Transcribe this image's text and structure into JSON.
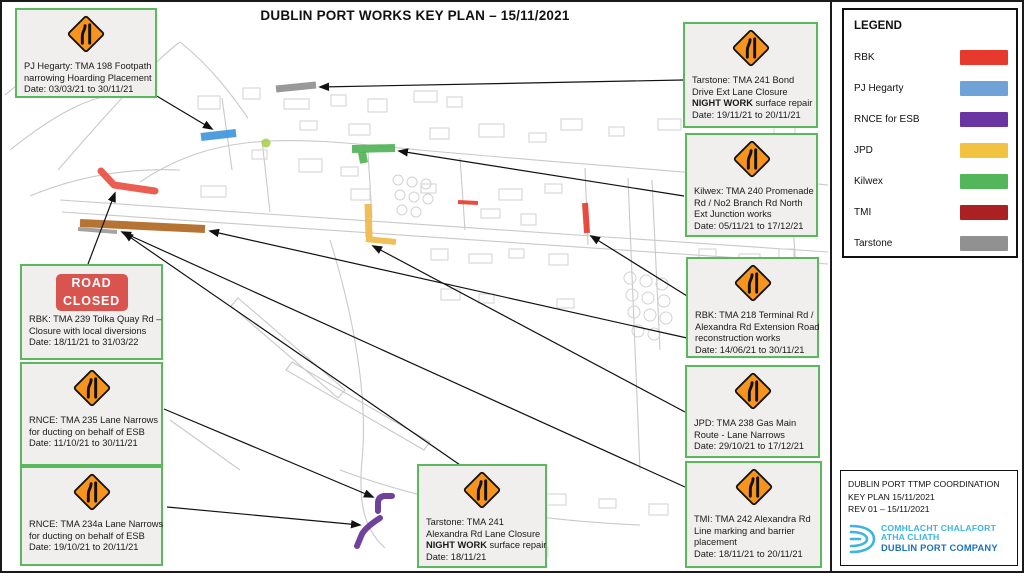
{
  "title": "DUBLIN PORT WORKS KEY PLAN – 15/11/2021",
  "colors": {
    "callout_border": "#5cb85c",
    "sign_orange": "#f7941e",
    "road_closed_red": "#d9534f",
    "logo_light_blue": "#3cb4e5",
    "logo_dark_blue": "#1d71b8",
    "arrow_black": "#111111"
  },
  "legend": {
    "title": "LEGEND",
    "items": [
      {
        "label": "RBK",
        "color": "#e63a2e"
      },
      {
        "label": "PJ Hegarty",
        "color": "#6fa3d8"
      },
      {
        "label": "RNCE for ESB",
        "color": "#6a35a3"
      },
      {
        "label": "JPD",
        "color": "#f2c340"
      },
      {
        "label": "Kilwex",
        "color": "#53b65a"
      },
      {
        "label": "TMI",
        "color": "#aa2023"
      },
      {
        "label": "Tarstone",
        "color": "#919191"
      }
    ]
  },
  "info_box": {
    "lines": [
      "DUBLIN PORT TTMP COORDINATION",
      "KEY PLAN  15/11/2021",
      "REV 01 – 15/11/2021"
    ],
    "logo": {
      "line1": "COMHLACHT CHALAFORT",
      "line2": "ATHA CLIATH",
      "line3": "DUBLIN PORT COMPANY"
    }
  },
  "callouts": [
    {
      "id": "pj-hegarty-198",
      "sign": "narrows",
      "box": {
        "x": 15,
        "y": 8,
        "w": 142,
        "h": 90
      },
      "lines": [
        [
          {
            "t": "PJ Hegarty: TMA 198 Footpath"
          }
        ],
        [
          {
            "t": "narrowing Hoarding Placement"
          }
        ],
        [
          {
            "t": "Date: 03/03/21 to 30/11/21"
          }
        ]
      ]
    },
    {
      "id": "rbk-239",
      "sign": "road_closed",
      "sign_text": [
        "ROAD",
        "CLOSED"
      ],
      "box": {
        "x": 20,
        "y": 264,
        "w": 143,
        "h": 96
      },
      "lines": [
        [
          {
            "t": "RBK: TMA 239 Tolka Quay Rd –"
          }
        ],
        [
          {
            "t": "Closure with local diversions"
          }
        ],
        [
          {
            "t": "Date: 18/11/21 to 31/03/22"
          }
        ]
      ]
    },
    {
      "id": "rnce-235",
      "sign": "narrows",
      "box": {
        "x": 20,
        "y": 362,
        "w": 143,
        "h": 104
      },
      "lines": [
        [
          {
            "t": "RNCE: TMA 235 Lane Narrows"
          }
        ],
        [
          {
            "t": "for ducting on behalf of ESB"
          }
        ],
        [
          {
            "t": "Date: 11/10/21 to 30/11/21"
          }
        ]
      ]
    },
    {
      "id": "rnce-234a",
      "sign": "narrows",
      "box": {
        "x": 20,
        "y": 466,
        "w": 143,
        "h": 100
      },
      "lines": [
        [
          {
            "t": "RNCE: TMA 234a Lane Narrows"
          }
        ],
        [
          {
            "t": "for ducting on behalf of ESB"
          }
        ],
        [
          {
            "t": "Date: 19/10/21 to 20/11/21"
          }
        ]
      ]
    },
    {
      "id": "tarstone-241-alexandra",
      "sign": "narrows",
      "box": {
        "x": 417,
        "y": 464,
        "w": 130,
        "h": 104
      },
      "lines": [
        [
          {
            "t": "Tarstone: TMA 241"
          }
        ],
        [
          {
            "t": "Alexandra Rd Lane Closure"
          }
        ],
        [
          {
            "t": "NIGHT WORK",
            "b": true
          },
          {
            "t": " surface repair"
          }
        ],
        [
          {
            "t": "Date: 18/11/21"
          }
        ]
      ]
    },
    {
      "id": "tarstone-241-bond",
      "sign": "narrows",
      "box": {
        "x": 683,
        "y": 22,
        "w": 135,
        "h": 106
      },
      "lines": [
        [
          {
            "t": "Tarstone: TMA 241 Bond"
          }
        ],
        [
          {
            "t": "Drive Ext Lane Closure"
          }
        ],
        [
          {
            "t": "NIGHT WORK",
            "b": true
          },
          {
            "t": " surface repair"
          }
        ],
        [
          {
            "t": "Date: 19/11/21 to 20/11/21"
          }
        ]
      ]
    },
    {
      "id": "kilwex-240",
      "sign": "narrows",
      "box": {
        "x": 685,
        "y": 133,
        "w": 133,
        "h": 104
      },
      "lines": [
        [
          {
            "t": "Kilwex: TMA 240 Promenade"
          }
        ],
        [
          {
            "t": "Rd / No2 Branch Rd North"
          }
        ],
        [
          {
            "t": "Ext Junction works"
          }
        ],
        [
          {
            "t": "Date: 05/11/21 to 17/12/21"
          }
        ]
      ]
    },
    {
      "id": "rbk-218",
      "sign": "narrows",
      "box": {
        "x": 686,
        "y": 257,
        "w": 133,
        "h": 101
      },
      "lines": [
        [
          {
            "t": "RBK: TMA 218 Terminal Rd /"
          }
        ],
        [
          {
            "t": "Alexandra Rd Extension Road"
          }
        ],
        [
          {
            "t": "reconstruction works"
          }
        ],
        [
          {
            "t": "Date: 14/06/21 to 30/11/21"
          }
        ]
      ]
    },
    {
      "id": "jpd-238",
      "sign": "narrows",
      "box": {
        "x": 685,
        "y": 365,
        "w": 135,
        "h": 93
      },
      "lines": [
        [
          {
            "t": "JPD: TMA 238 Gas Main"
          }
        ],
        [
          {
            "t": "Route - Lane Narrows"
          }
        ],
        [
          {
            "t": "Date: 29/10/21 to 17/12/21"
          }
        ]
      ]
    },
    {
      "id": "tmi-242",
      "sign": "narrows",
      "box": {
        "x": 685,
        "y": 461,
        "w": 137,
        "h": 107
      },
      "lines": [
        [
          {
            "t": "TMI: TMA 242 Alexandra Rd"
          }
        ],
        [
          {
            "t": "Line marking and barrier"
          }
        ],
        [
          {
            "t": "placement"
          }
        ],
        [
          {
            "t": "Date: 18/11/21 to 20/11/21"
          }
        ]
      ]
    }
  ],
  "map": {
    "segments": [
      {
        "id": "pj-hegarty-footpath",
        "kind": "line",
        "x1": 201,
        "y1": 137,
        "x2": 236,
        "y2": 133,
        "color": "#3d94dd",
        "w": 8
      },
      {
        "id": "tarstone-bond-drive",
        "kind": "line",
        "x1": 276,
        "y1": 89,
        "x2": 316,
        "y2": 85,
        "color": "#8f8f8f",
        "w": 7
      },
      {
        "id": "kilwex-junction-main",
        "kind": "line",
        "x1": 352,
        "y1": 149,
        "x2": 395,
        "y2": 148,
        "color": "#4fb254",
        "w": 8
      },
      {
        "id": "kilwex-junction-stub",
        "kind": "line",
        "x1": 362,
        "y1": 152,
        "x2": 364,
        "y2": 163,
        "color": "#4fb254",
        "w": 8
      },
      {
        "id": "roundabout-marker",
        "kind": "circle",
        "cx": 266,
        "cy": 143,
        "r": 4.5,
        "color": "#a6d34c"
      },
      {
        "id": "rbk-tolka-closure",
        "kind": "path",
        "d": "M101,171 L114,185 L155,191",
        "color": "#ea4b3e",
        "w": 7
      },
      {
        "id": "rbk-alexandra-extension",
        "kind": "line",
        "x1": 80,
        "y1": 223,
        "x2": 205,
        "y2": 229,
        "color": "#ad661f",
        "w": 8
      },
      {
        "id": "tarstone-alexandra",
        "kind": "line",
        "x1": 78,
        "y1": 229,
        "x2": 117,
        "y2": 232,
        "color": "#9a9a9a",
        "w": 4
      },
      {
        "id": "jpd-gas-main-vertical",
        "kind": "line",
        "x1": 368,
        "y1": 204,
        "x2": 369,
        "y2": 237,
        "color": "#f0b948",
        "w": 7
      },
      {
        "id": "jpd-gas-main-horizontal",
        "kind": "line",
        "x1": 366,
        "y1": 239,
        "x2": 396,
        "y2": 242,
        "color": "#f0b948",
        "w": 6
      },
      {
        "id": "rbk-terminal-rd",
        "kind": "line",
        "x1": 585,
        "y1": 203,
        "x2": 587,
        "y2": 233,
        "color": "#e8392b",
        "w": 6
      },
      {
        "id": "rbk-terminal-spur",
        "kind": "line",
        "x1": 458,
        "y1": 202,
        "x2": 478,
        "y2": 203,
        "color": "#e8392b",
        "w": 4
      },
      {
        "id": "rnce-235-ducting",
        "kind": "path",
        "d": "M378,511 L378,503 Q378,497 384,496 L392,496",
        "color": "#5f2d91",
        "w": 6
      },
      {
        "id": "rnce-234a-ducting",
        "kind": "path",
        "d": "M380,518 Q366,527 362,534 L357,546",
        "color": "#5f2d91",
        "w": 6
      }
    ],
    "arrows": [
      {
        "x1": 150,
        "y1": 92,
        "x2": 212,
        "y2": 129
      },
      {
        "x1": 683,
        "y1": 80,
        "x2": 320,
        "y2": 87
      },
      {
        "x1": 684,
        "y1": 196,
        "x2": 399,
        "y2": 151
      },
      {
        "x1": 687,
        "y1": 296,
        "x2": 591,
        "y2": 236
      },
      {
        "x1": 687,
        "y1": 338,
        "x2": 210,
        "y2": 231
      },
      {
        "x1": 685,
        "y1": 412,
        "x2": 373,
        "y2": 246
      },
      {
        "x1": 685,
        "y1": 487,
        "x2": 122,
        "y2": 232
      },
      {
        "x1": 88,
        "y1": 264,
        "x2": 115,
        "y2": 193
      },
      {
        "x1": 164,
        "y1": 409,
        "x2": 373,
        "y2": 497
      },
      {
        "x1": 167,
        "y1": 507,
        "x2": 360,
        "y2": 525
      },
      {
        "x1": 463,
        "y1": 467,
        "x2": 124,
        "y2": 233
      }
    ]
  }
}
